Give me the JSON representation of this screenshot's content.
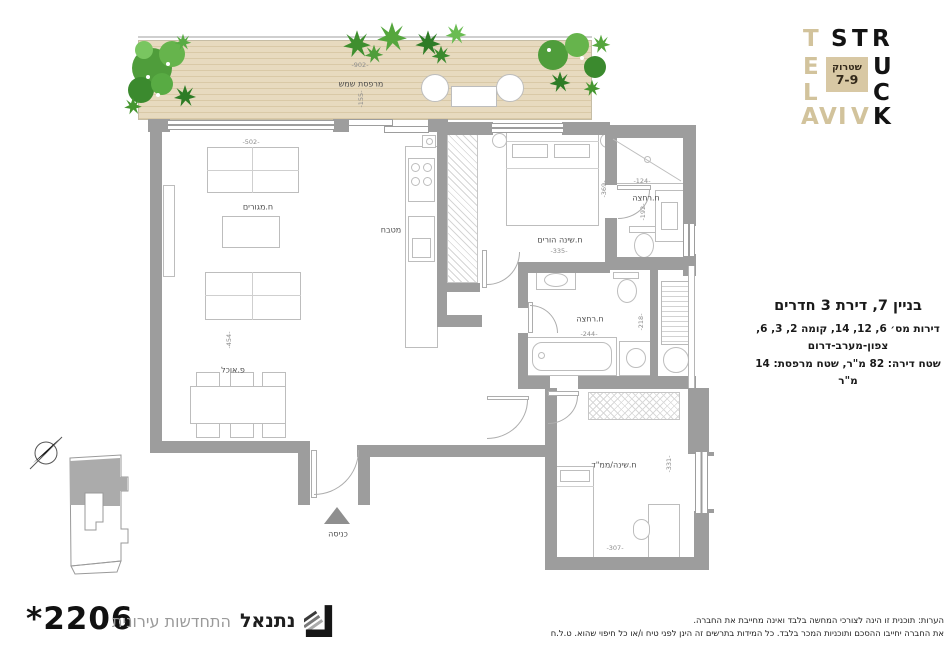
{
  "logo": {
    "tan_letters": [
      "T",
      "E",
      "L",
      "A",
      "V",
      "I",
      "V"
    ],
    "black_letters": [
      "S",
      "T",
      "R",
      "U",
      "C",
      "K"
    ],
    "square_top": "שטרוק",
    "square_bottom": "7-9"
  },
  "apartment_info": {
    "title": "בניין 7, דירת 3 חדרים",
    "line1": "דירות מס׳ 6, 12, 14, קומה 2, 3, 6,",
    "line2": "צפון-מערב-דרום",
    "line3": "שטח דירה: 82 מ\"ר, שטח מרפסת: 14 מ\"ר"
  },
  "plan": {
    "room_labels": [
      {
        "text": "מרפסת שמש",
        "x": 361,
        "y": 84
      },
      {
        "text": "ח.מגורים",
        "x": 258,
        "y": 207
      },
      {
        "text": "פ.אוכל",
        "x": 233,
        "y": 370
      },
      {
        "text": "מטבח",
        "x": 391,
        "y": 230
      },
      {
        "text": "ח.שינה הורים",
        "x": 560,
        "y": 240
      },
      {
        "text": "ח.רחצה",
        "x": 646,
        "y": 198
      },
      {
        "text": "ח.רחצה",
        "x": 590,
        "y": 319
      },
      {
        "text": "ח.שינה/ממ\"ד",
        "x": 614,
        "y": 465
      },
      {
        "text": "כניסה",
        "x": 338,
        "y": 534
      }
    ],
    "dim_labels": [
      {
        "text": "-902-",
        "x": 360,
        "y": 65,
        "v": false
      },
      {
        "text": "-155-",
        "x": 361,
        "y": 99,
        "v": true
      },
      {
        "text": "-502-",
        "x": 251,
        "y": 142,
        "v": false
      },
      {
        "text": "-454-",
        "x": 229,
        "y": 340,
        "v": true
      },
      {
        "text": "-335-",
        "x": 559,
        "y": 251,
        "v": false
      },
      {
        "text": "-369-",
        "x": 604,
        "y": 189,
        "v": true
      },
      {
        "text": "-124-",
        "x": 642,
        "y": 181,
        "v": false
      },
      {
        "text": "-192-",
        "x": 643,
        "y": 212,
        "v": true
      },
      {
        "text": "-244-",
        "x": 589,
        "y": 334,
        "v": false
      },
      {
        "text": "-218-",
        "x": 641,
        "y": 322,
        "v": true
      },
      {
        "text": "-307-",
        "x": 615,
        "y": 548,
        "v": false
      },
      {
        "text": "-331-",
        "x": 669,
        "y": 464,
        "v": true
      }
    ]
  },
  "footer": {
    "phone_display": "*2206",
    "brand": "נתנאל",
    "tagline": "התחדשות עירונית"
  },
  "notes": {
    "line1": "הערות: תוכנית זו הינה לצורכי המחשה בלבד ואינה מחייבת את החברה.",
    "line2": "את החברה יחייבו ההסכם ותוכניות המכר בלבד. כל המידות בתרשים זה הינן לפני טיח ו/או כל חיפוי שהוא. ט.ל.ח"
  },
  "colors": {
    "wall": "#9d9d9d",
    "deck": "#e7dabf",
    "logo_tan": "#d2c39c",
    "logo_square": "#d8c8a4",
    "plant_green": "#4d9e3c",
    "text_dark": "#1a1a1a",
    "text_gray": "#9a9a9a"
  }
}
